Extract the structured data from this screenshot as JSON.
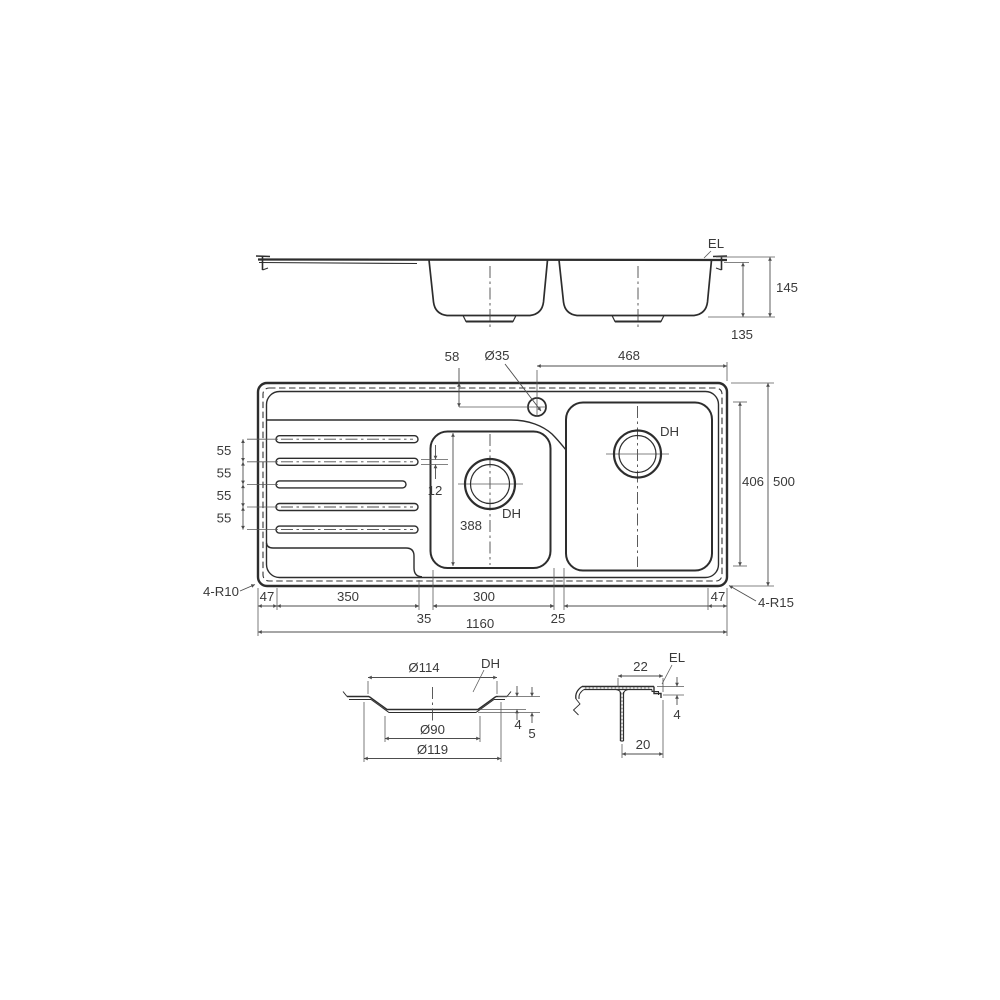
{
  "elevation": {
    "el": "EL",
    "overall_height": "145",
    "bowl_depth": "135"
  },
  "plan": {
    "tap_offset": "58",
    "tap_dia": "Ø35",
    "tap_to_edge": "468",
    "inner_width": "406",
    "overall_width": "500",
    "pitch": [
      "55",
      "55",
      "55",
      "55"
    ],
    "groove_width": "12",
    "small_bowl_length": "388",
    "dh_small": "DH",
    "dh_large": "DH",
    "radius_left": "4-R10",
    "radius_right": "4-R15",
    "left_margin": "47",
    "drainer_length": "350",
    "step_gap": "35",
    "small_bowl_width": "300",
    "divider": "25",
    "right_margin": "47",
    "overall_length": "1160"
  },
  "drain_detail": {
    "dh": "DH",
    "top_dia": "Ø114",
    "bottom_dia": "Ø90",
    "outer_dia": "Ø119",
    "step_depth": "4",
    "total_depth": "5"
  },
  "edge_detail": {
    "el": "EL",
    "top_width": "22",
    "lip_height": "4",
    "bottom_width": "20"
  }
}
